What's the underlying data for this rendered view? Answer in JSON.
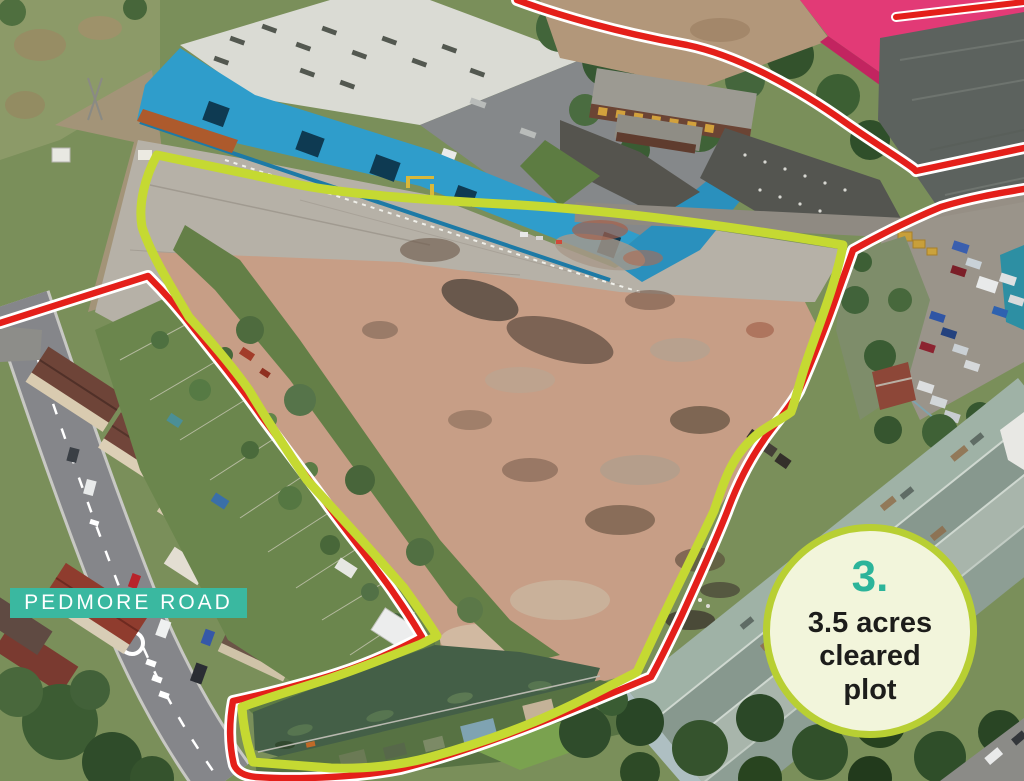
{
  "annotations": {
    "road_label": {
      "text": "PEDMORE ROAD"
    },
    "plot_badge": {
      "number": "3.",
      "lines": [
        "3.5 acres",
        "cleared",
        "plot"
      ]
    }
  },
  "colors": {
    "plot_outline": "#c5d932",
    "route_line": "#e41f1a",
    "route_casing": "#ffffff",
    "road_label_bg": "#3ab8a0",
    "road_label_text": "#ffffff",
    "badge_fill": "#f2f5db",
    "badge_border": "#b8cf33",
    "badge_number_color": "#2cb49a",
    "badge_text_color": "#1d1d1b"
  }
}
